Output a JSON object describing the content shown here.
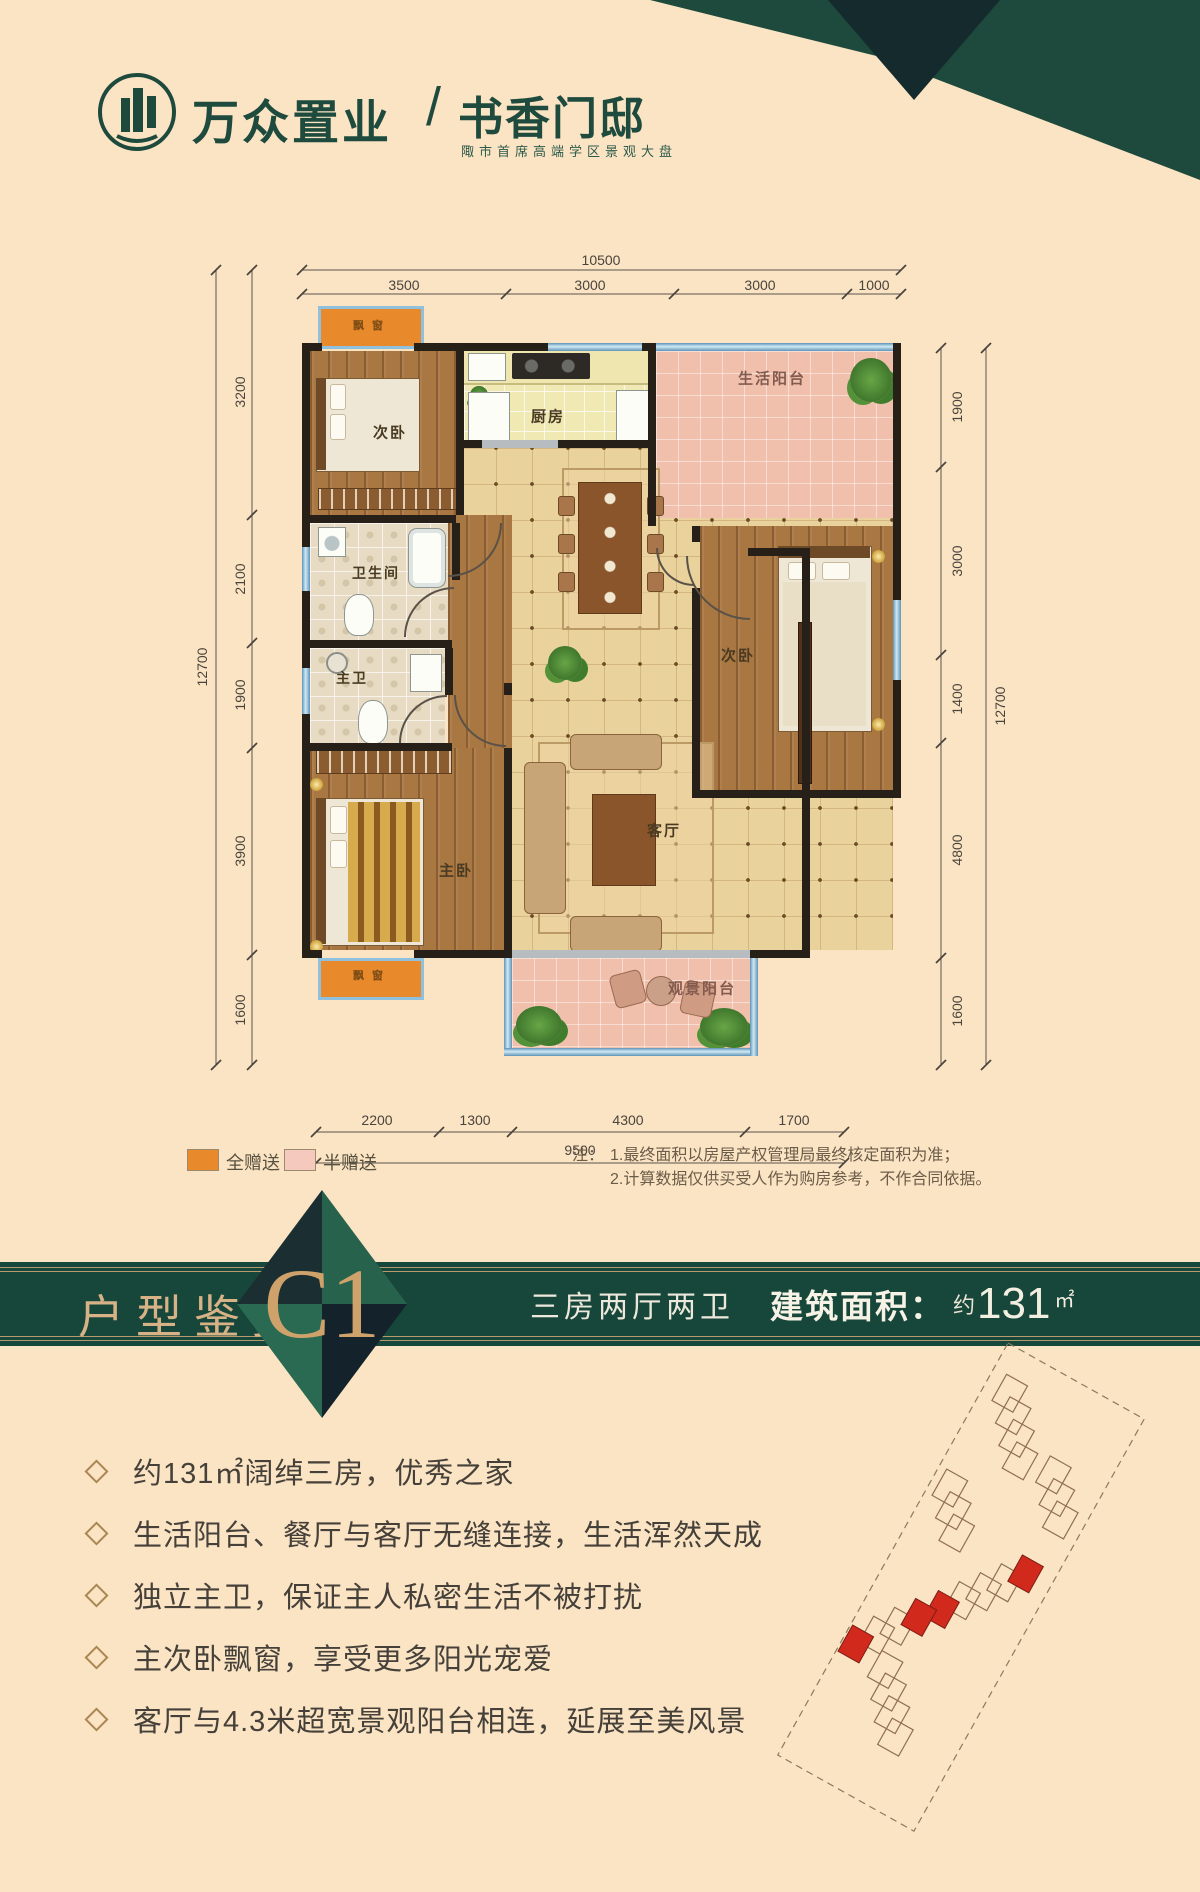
{
  "header": {
    "brand": "万众置业",
    "separator": "/",
    "project": "书香门邸",
    "tagline": "陬市首席高端学区景观大盘"
  },
  "floorplan": {
    "rooms": {
      "bay_window_top": "飘窗",
      "bedroom_top": "次卧",
      "kitchen": "厨房",
      "service_balcony": "生活阳台",
      "bathroom": "卫生间",
      "bedroom_right": "次卧",
      "master_bathroom": "主卫",
      "master_bedroom": "主卧",
      "living_room": "客厅",
      "view_balcony": "观景阳台",
      "bay_window_bottom": "飘窗"
    },
    "dimensions": {
      "top_total": "10500",
      "top_segments": [
        "3500",
        "3000",
        "3000",
        "1000"
      ],
      "left_total": "12700",
      "left_segments": [
        "3200",
        "2100",
        "1900",
        "3900",
        "1600"
      ],
      "right_total": "12700",
      "right_segments": [
        "1900",
        "3000",
        "1400",
        "4800",
        "1600"
      ],
      "bottom_total": "9500",
      "bottom_segments": [
        "2200",
        "1300",
        "4300",
        "1700"
      ]
    },
    "legend": [
      {
        "label": "全赠送",
        "color": "#e8892b"
      },
      {
        "label": "半赠送",
        "color": "#f5c9bd"
      }
    ],
    "note": {
      "prefix": "注：",
      "line1": "1.最终面积以房屋产权管理局最终核定面积为准；",
      "line2": "2.计算数据仅供买受人作为购房参考，不作合同依据。"
    }
  },
  "banner": {
    "section_title": "户型鉴赏",
    "unit_code": "C1",
    "layout_text": "三房两厅两卫",
    "area_label": "建筑面积",
    "colon": "：",
    "area_approx": "约",
    "area_value": "131",
    "area_unit": "㎡"
  },
  "features": {
    "items": [
      "约131㎡阔绰三房，优秀之家",
      "生活阳台、餐厅与客厅无缝连接，生活浑然天成",
      "独立主卫，保证主人私密生活不被打扰",
      "主次卧飘窗，享受更多阳光宠爱",
      "客厅与4.3米超宽景观阳台相连，延展至美风景"
    ]
  },
  "colors": {
    "brand_green": "#1d4a3c",
    "banner_green": "#17463a",
    "gold": "#c9a36b",
    "full_gift_orange": "#e8892b",
    "half_gift_pink": "#f5c9bd",
    "highlight_red": "#d2291d"
  }
}
